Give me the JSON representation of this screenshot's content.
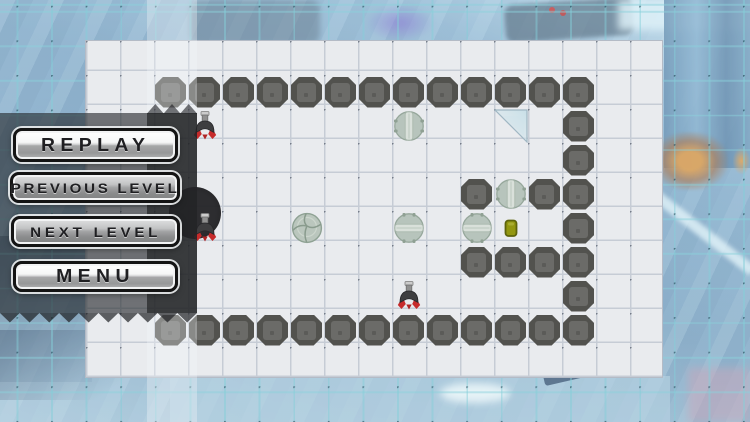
{
  "menu": {
    "buttons": [
      {
        "id": "replay",
        "label": "REPLAY",
        "style": "bright"
      },
      {
        "id": "previous-level",
        "label": "PREVIOUS LEVEL",
        "style": "dark"
      },
      {
        "id": "next-level",
        "label": "NEXT LEVEL",
        "style": "dark"
      },
      {
        "id": "menu",
        "label": "MENU",
        "style": "bright"
      }
    ]
  },
  "board": {
    "cols": 17,
    "rows": 10,
    "cell_px": 34
  },
  "level": {
    "walls": [
      [
        2,
        1
      ],
      [
        3,
        1
      ],
      [
        4,
        1
      ],
      [
        5,
        1
      ],
      [
        6,
        1
      ],
      [
        7,
        1
      ],
      [
        8,
        1
      ],
      [
        9,
        1
      ],
      [
        10,
        1
      ],
      [
        11,
        1
      ],
      [
        12,
        1
      ],
      [
        13,
        1
      ],
      [
        14,
        1
      ],
      [
        14,
        2
      ],
      [
        14,
        3
      ],
      [
        14,
        4
      ],
      [
        14,
        5
      ],
      [
        14,
        6
      ],
      [
        14,
        7
      ],
      [
        11,
        4
      ],
      [
        13,
        4
      ],
      [
        11,
        6
      ],
      [
        12,
        6
      ],
      [
        13,
        6
      ],
      [
        2,
        8
      ],
      [
        3,
        8
      ],
      [
        4,
        8
      ],
      [
        5,
        8
      ],
      [
        6,
        8
      ],
      [
        7,
        8
      ],
      [
        8,
        8
      ],
      [
        9,
        8
      ],
      [
        10,
        8
      ],
      [
        11,
        8
      ],
      [
        12,
        8
      ],
      [
        13,
        8
      ],
      [
        14,
        8
      ]
    ],
    "rockets": [
      {
        "col": 3,
        "row": 2,
        "facing": "up"
      },
      {
        "col": 3,
        "row": 5,
        "facing": "up",
        "on_hole": true
      },
      {
        "col": 9,
        "row": 7,
        "facing": "up"
      }
    ],
    "rollers": [
      {
        "col": 9,
        "row": 2,
        "split": "vertical"
      },
      {
        "col": 12,
        "row": 4,
        "split": "vertical"
      },
      {
        "col": 9,
        "row": 5,
        "split": "horizontal"
      },
      {
        "col": 11,
        "row": 5,
        "split": "horizontal"
      }
    ],
    "boulder": {
      "col": 6,
      "row": 5
    },
    "glass_triangle": {
      "col": 12,
      "row": 2,
      "right_angle": "top-right"
    },
    "key": {
      "col": 12,
      "row": 5
    },
    "hole": {
      "cx": 194,
      "cy": 212,
      "r": 26
    }
  },
  "colors": {
    "board_bg": "#e9ebee",
    "grid_line": "#c6ccd5",
    "wall_face": "#7a7a77",
    "wall_border": "#52524e",
    "rocket_wing_red": "#c62b2b",
    "roller_green": "#b7c4bc",
    "key_yellow": "#939710",
    "bg_grid_teal": "#8ad1db",
    "menu_panel_dark": "#24262a"
  }
}
